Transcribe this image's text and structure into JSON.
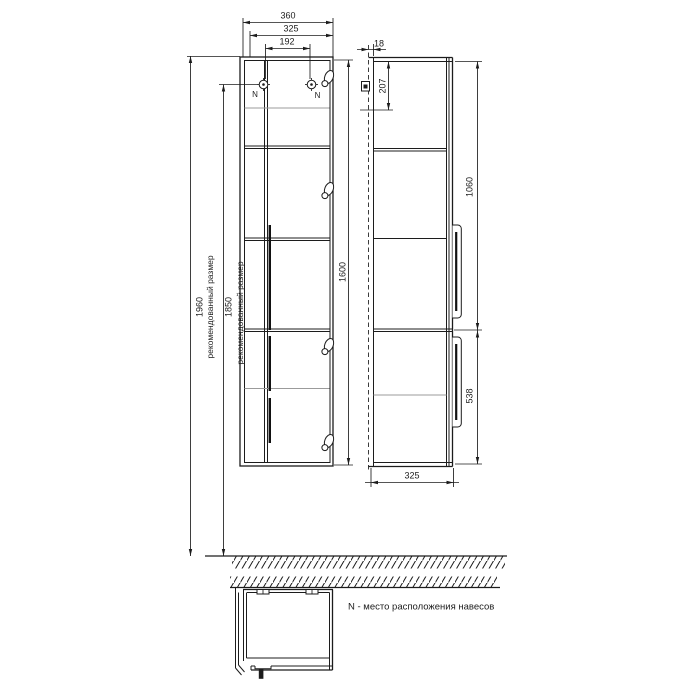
{
  "drawing": {
    "dimensions": {
      "total_width": "360",
      "door_width": "325",
      "hanger_spacing": "192",
      "recommended_total_height": "1960",
      "recommended_hanger_height": "1850",
      "recommended_size_label": "рекомендованный размер",
      "cabinet_height": "1600",
      "wall_gap": "18",
      "hanger_offset_from_top": "207",
      "upper_door_height": "1060",
      "lower_door_height": "538",
      "depth": "325"
    },
    "annotations": {
      "hanger_marker": "N",
      "note": "N - место расположения навесов"
    }
  }
}
